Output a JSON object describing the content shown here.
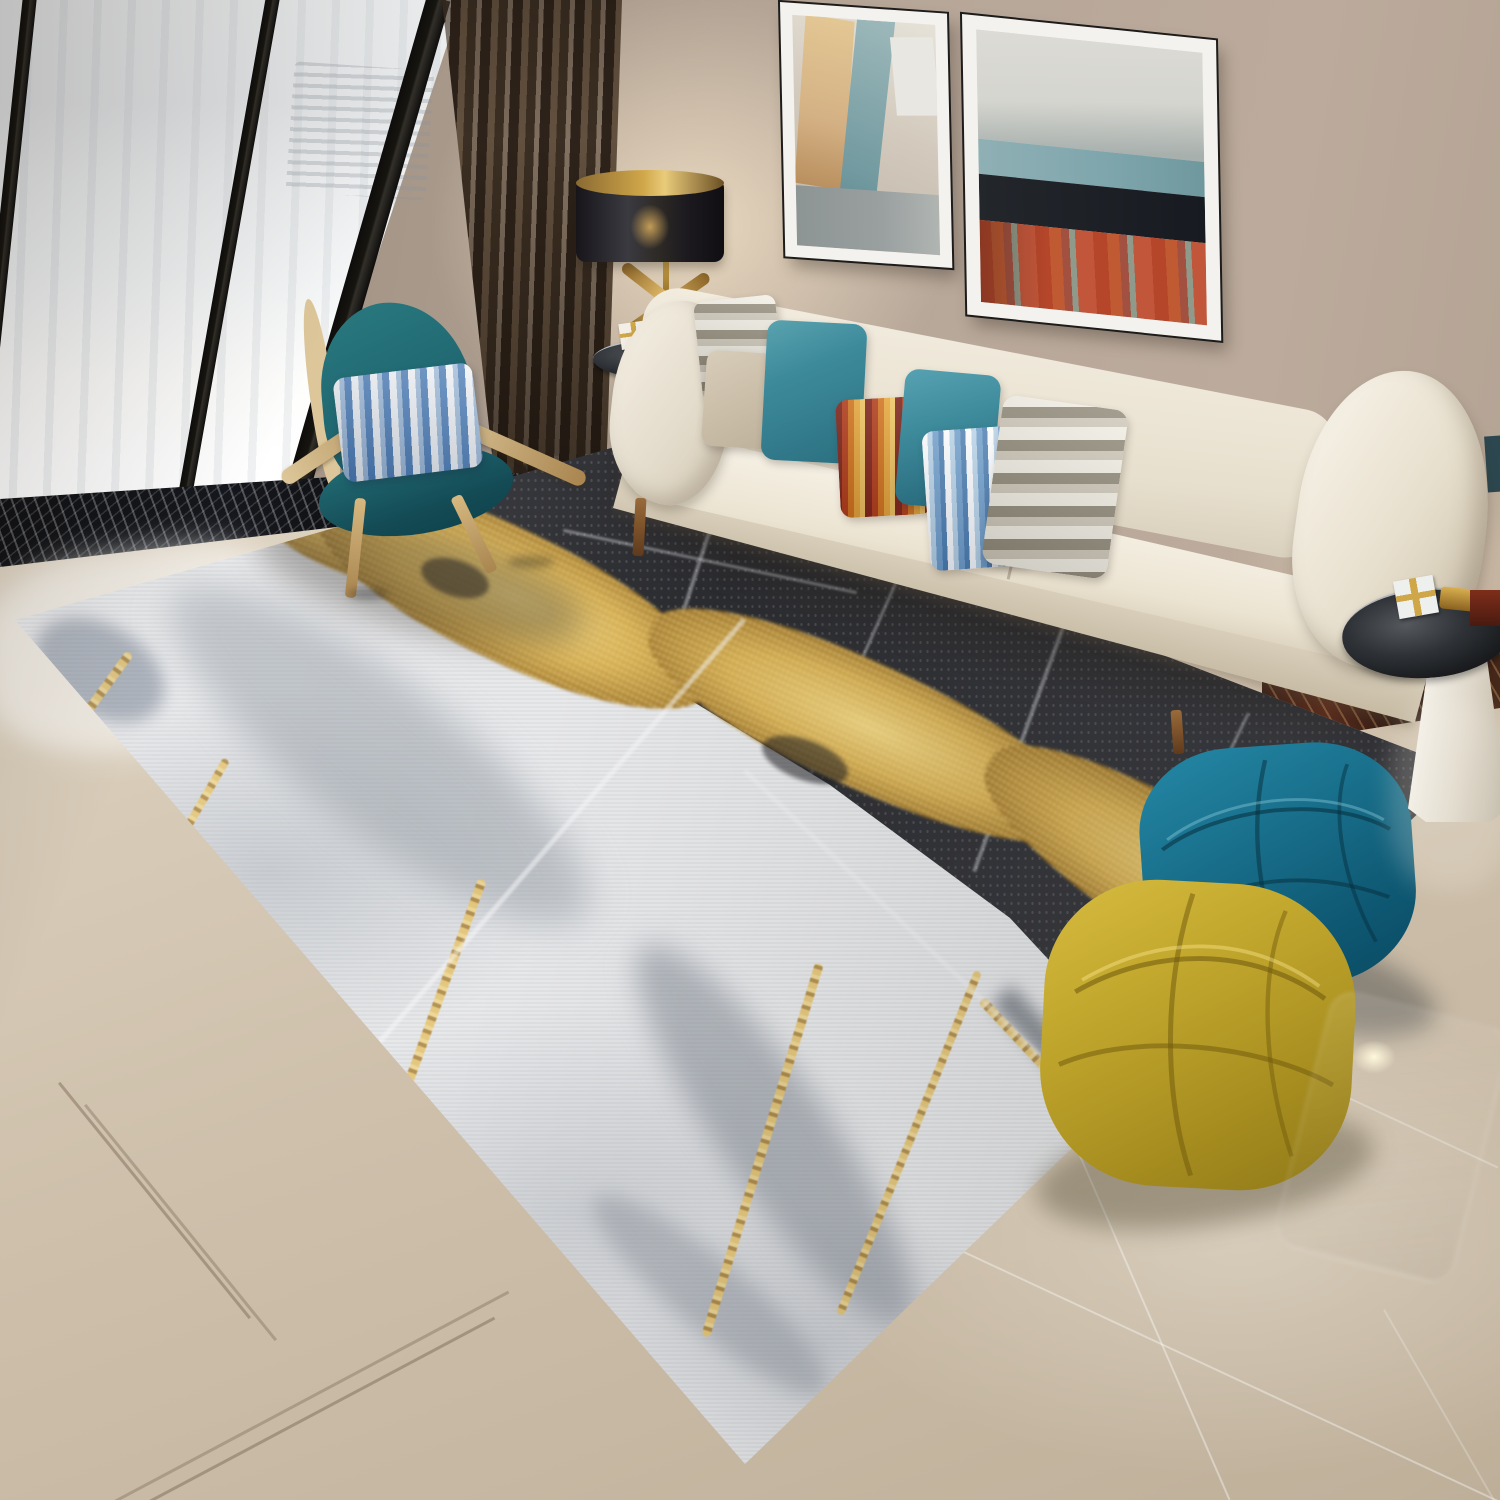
{
  "image_type": "interior product photograph (no visible text)",
  "scene": {
    "room": "modern living room",
    "product": "abstract marble-pattern area rug in white, grey, black and gold",
    "objects": [
      {
        "name": "floor-to-ceiling-window",
        "color": "#f4f6f7"
      },
      {
        "name": "window-frame",
        "color": "#17150f"
      },
      {
        "name": "sheer-curtain",
        "color": "#f7f8f9"
      },
      {
        "name": "blackout-curtain",
        "color": "#4a3a2c"
      },
      {
        "name": "wall",
        "color": "#ab9c8e"
      },
      {
        "name": "abstract-painting-left",
        "colors": [
          "#d4b184",
          "#6f989e",
          "#9aa0a0"
        ]
      },
      {
        "name": "abstract-painting-right",
        "colors": [
          "#d5d5cf",
          "#7fa6ad",
          "#171b21",
          "#c05a32"
        ]
      },
      {
        "name": "table-lamp",
        "colors": [
          "#2e2a26",
          "#c9a24a"
        ]
      },
      {
        "name": "cream-sofa",
        "color": "#efe8da"
      },
      {
        "name": "throw-pillows",
        "colors": [
          "#57a2b2",
          "#b33d1c",
          "#6f9ecb",
          "#948d7d",
          "#d8cdb9"
        ]
      },
      {
        "name": "teal-shell-chair",
        "colors": [
          "#1f6670",
          "#ddc79a"
        ]
      },
      {
        "name": "striped-chair-pillow",
        "colors": [
          "#f2f4f6",
          "#4779b4"
        ]
      },
      {
        "name": "marble-area-rug",
        "colors": [
          "#e7e8ea",
          "#2b2c30",
          "#cfa648",
          "#aab0b8"
        ]
      },
      {
        "name": "teal-pouf",
        "color": "#19708c"
      },
      {
        "name": "yellow-pouf",
        "color": "#c3a82e"
      },
      {
        "name": "glass-side-table",
        "colors": [
          "#2e3236",
          "#f0ece2"
        ]
      },
      {
        "name": "glossy-tile-floor",
        "color": "#d5c8b5"
      }
    ]
  },
  "palette": {
    "wall_a": "#8d7f71",
    "wall_b": "#b6a698",
    "floor_a": "#ebe2d3",
    "floor_b": "#cec0ab",
    "floor_c": "#bfb09a",
    "sheer": "#f4f6f7",
    "frame": "#17150f",
    "curtain_a": "#63513f",
    "curtain_b": "#3b2e22",
    "curtain_c": "#2e231a",
    "ledge": "#15171c",
    "sofa_a": "#f6f1e6",
    "sofa_b": "#e7dfcd",
    "sofa_c": "#cabfa9",
    "rug_white": "#e7e8ea",
    "rug_black": "#2b2c30",
    "rug_black_b": "#43444a",
    "gold_a": "#ecd07c",
    "gold_b": "#cfa648",
    "gold_c": "#a07628",
    "teal_chair": "#1f6670",
    "teal_chair_d": "#134a54",
    "wood_a": "#ddc79a",
    "wood_b": "#a9854f",
    "pouf_teal_a": "#2488a6",
    "pouf_teal_b": "#0a4a62",
    "pouf_yellow_a": "#d8bc42",
    "pouf_yellow_b": "#8f7818",
    "pillow_teal_a": "#3d8a9b",
    "pillow_teal_b": "#236375",
    "po_a": "#7e241a",
    "po_b": "#b33d1c",
    "po_c": "#d4761f",
    "po_d": "#e8a93c",
    "po_e": "#f2c864",
    "pb_w": "#ffffff",
    "pb_a": "#b9d4e8",
    "pb_b": "#6f9ecb",
    "pb_c": "#4a7cb0",
    "pg_a": "#f2efe5",
    "pg_b": "#948d7d",
    "pg_c": "#cfc9ba",
    "pillow_beige_a": "#d8cdb9",
    "pillow_beige_b": "#bdb09a",
    "pillow_blue_c": "#4779b4",
    "glass_a": "#55595e",
    "glass_b": "#101214",
    "cone_a": "#f5f2ea",
    "cone_b": "#bfb6a4",
    "skirt_a": "#5a2e1e",
    "skirt_b": "#2a1812",
    "lamp": "#2e2a26",
    "art1_bg": "#d3cabd",
    "art1_tan": "#d4b184",
    "art1_teal": "#6f989e",
    "art1_gray": "#9aa0a0",
    "art2_sky": "#d5d5cf",
    "art2_teal": "#7fa6ad",
    "art2_dark": "#171b21",
    "art2_orange": "#c05a32"
  }
}
